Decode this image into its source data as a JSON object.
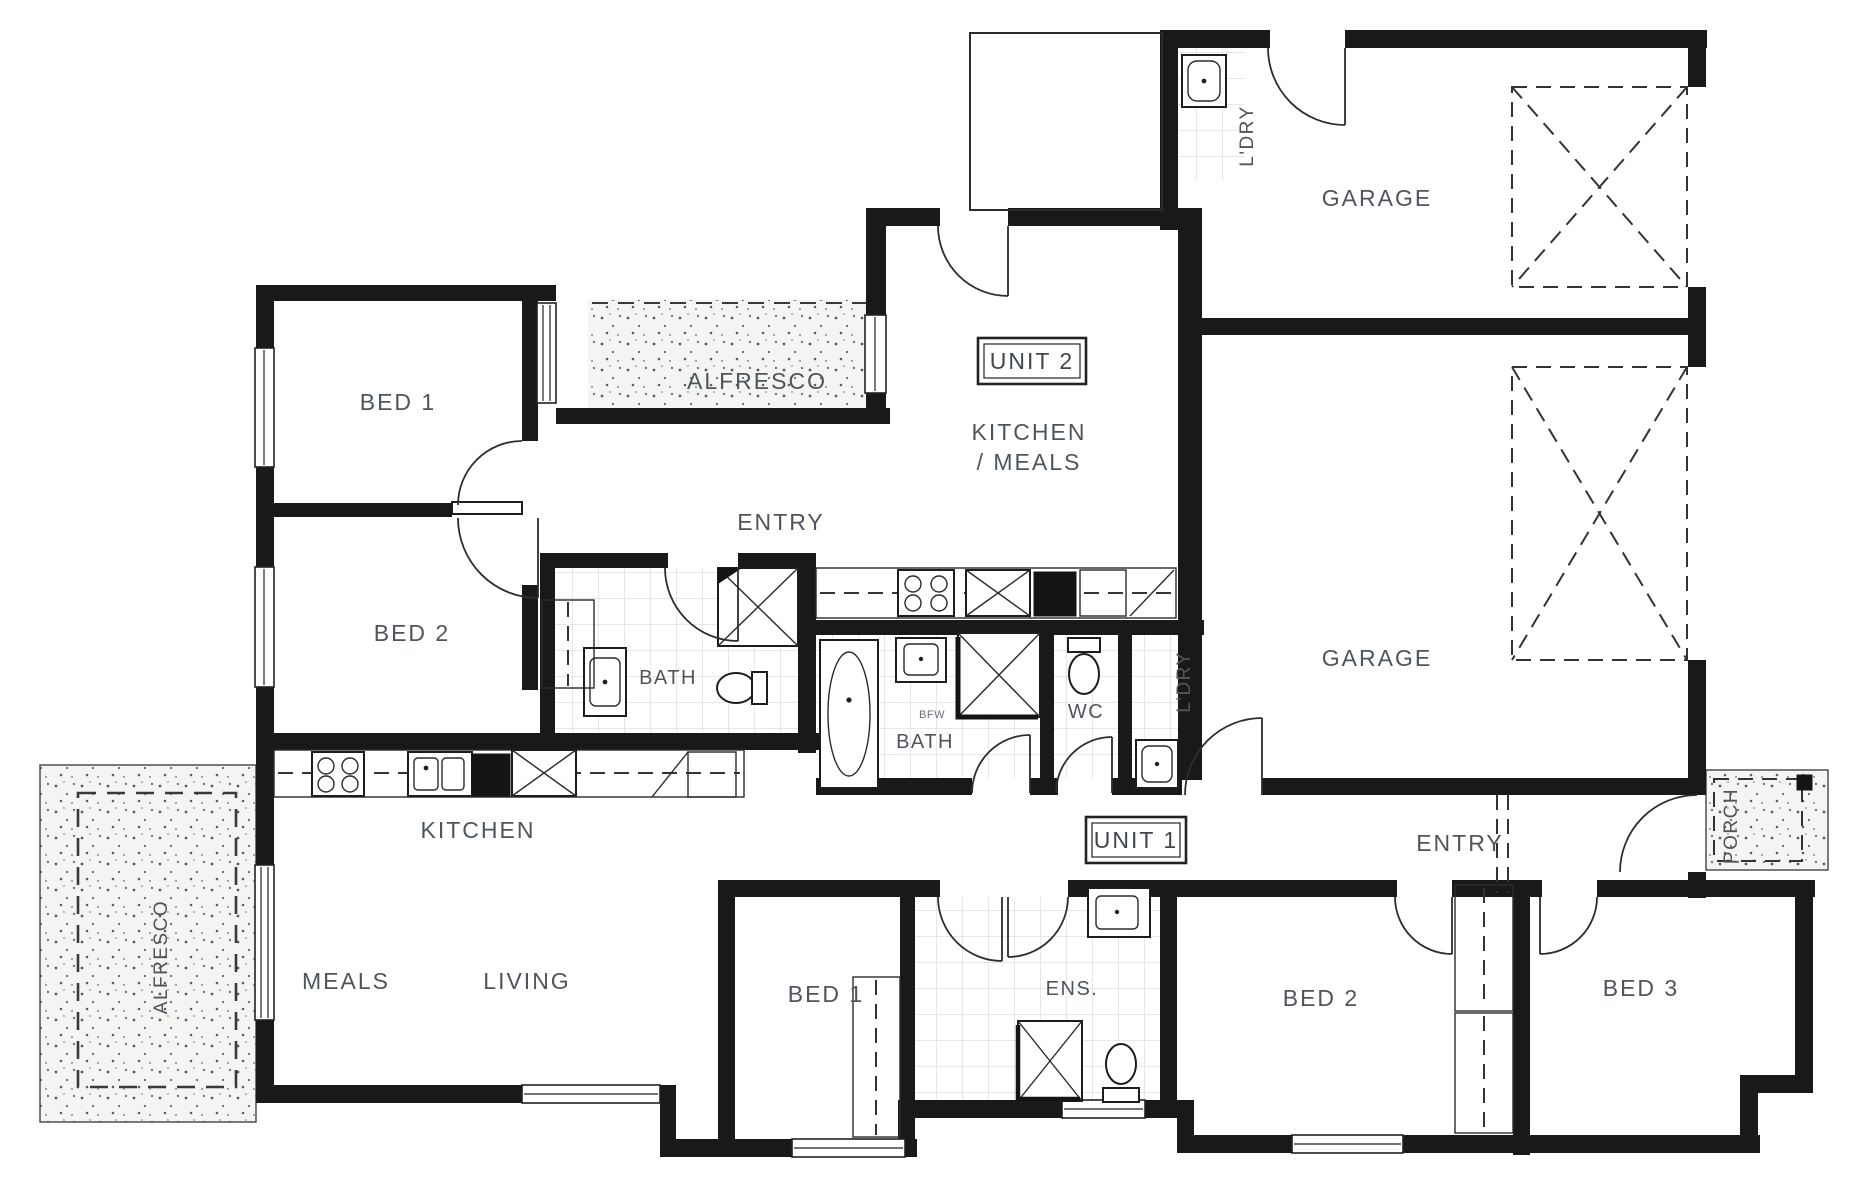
{
  "plan": {
    "unit2": {
      "tag": "UNIT 2",
      "garage": "GARAGE",
      "laundry": "L'DRY",
      "alfresco": "ALFRESCO",
      "bed1": "BED 1",
      "bed2": "BED 2",
      "entry": "ENTRY",
      "kitchen_meals_l1": "KITCHEN",
      "kitchen_meals_l2": "/ MEALS",
      "bath": "BATH"
    },
    "unit1": {
      "tag": "UNIT 1",
      "garage": "GARAGE",
      "laundry": "L'DRY",
      "alfresco": "ALFRESCO",
      "porch": "PORCH",
      "entry": "ENTRY",
      "kitchen": "KITCHEN",
      "meals": "MEALS",
      "living": "LIVING",
      "bath": "BATH",
      "bath_note": "BFW",
      "wc": "WC",
      "ens": "ENS.",
      "bed1": "BED 1",
      "bed2": "BED 2",
      "bed3": "BED 3"
    }
  },
  "colors": {
    "wall": "#191919",
    "label": "#4e555c",
    "paper": "#ffffff"
  }
}
